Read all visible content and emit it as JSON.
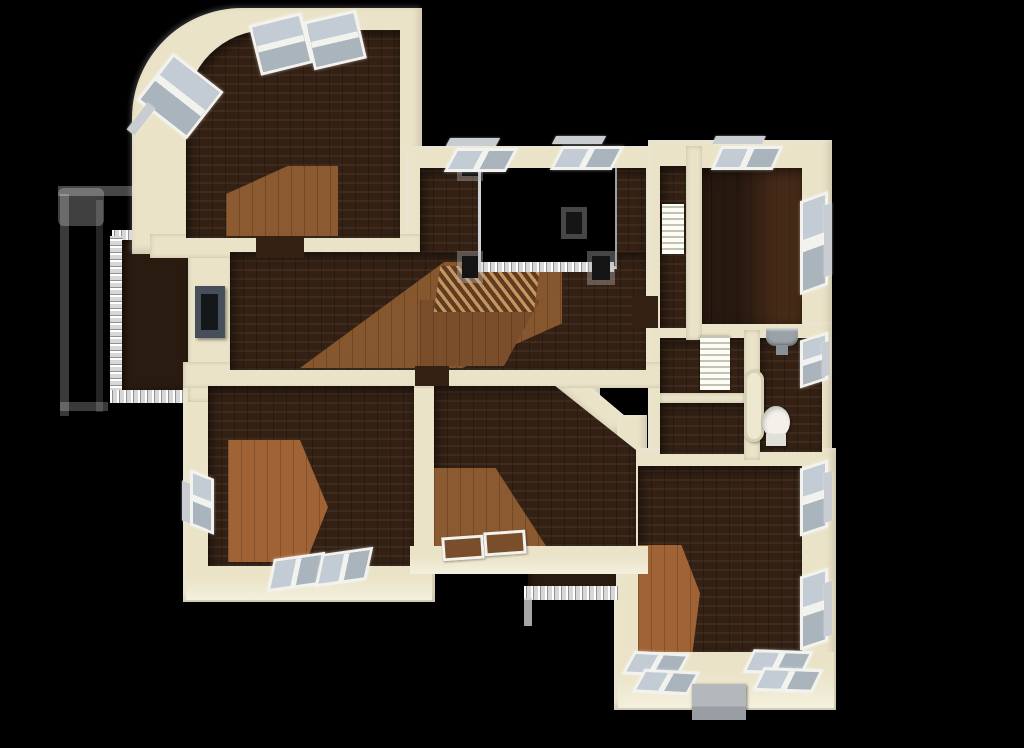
{
  "view": {
    "type": "3d-overhead-floorplan-render",
    "background": "black",
    "floor_material": "dark hardwood planks with warm sunlight patches",
    "wall_material": "cream plaster"
  },
  "colors": {
    "bg": "#000000",
    "wall": "#eae3c8",
    "wall-lit": "#f4f0dd",
    "floor-dark": "#342114",
    "floor-balcony": "#2a1b10",
    "sun-warm": "#8c5a30",
    "sun-strong": "#a06336",
    "sun-soft": "#7a4e2a",
    "window-frame": "#f2f2ef",
    "window-glass": "#c3ccd4",
    "sill": "#c9cdd1",
    "railing": "#d7d7d7",
    "post": "#141414",
    "fireplace-frame": "#47505a",
    "fireplace-inner": "#15181b",
    "fixture-white": "#f3f1ea",
    "fixture-gray": "#9aa2a8",
    "tub": "#efe8d0",
    "chimney": "#b4b8bd",
    "stair-light": "#c89a62",
    "stair-dark": "#5e3a20"
  },
  "inventory": {
    "rooms": [
      {
        "name": "bedroom-top-left",
        "features": [
          "curved corner wall",
          "two top windows",
          "angled corner window",
          "sunlit floor patch"
        ]
      },
      {
        "name": "central-hall",
        "features": [
          "fireplace inset in left wall",
          "black stairwell opening",
          "metal railing with black newel posts",
          "staircase treads",
          "two top windows"
        ]
      },
      {
        "name": "bedroom-top-right",
        "features": [
          "top window",
          "right window",
          "narrow closet with shelves"
        ]
      },
      {
        "name": "bathroom",
        "features": [
          "wall-hung sink",
          "toilet",
          "bathtub",
          "right window",
          "two closets with shelving"
        ]
      },
      {
        "name": "bedroom-bottom-left",
        "features": [
          "left window",
          "two bottom windows",
          "sunlit floor patch"
        ]
      },
      {
        "name": "room-bottom-center",
        "features": [
          "angled corner wall",
          "two low floor windows",
          "small balcony with railing"
        ]
      },
      {
        "name": "bedroom-bottom-right",
        "features": [
          "two right windows",
          "four bottom windows",
          "chimney block",
          "sunlit floor patch"
        ]
      }
    ],
    "exterior": [
      "left balcony with baluster railing",
      "ghosted white lower-level railing outline",
      "protruding window sills"
    ]
  }
}
